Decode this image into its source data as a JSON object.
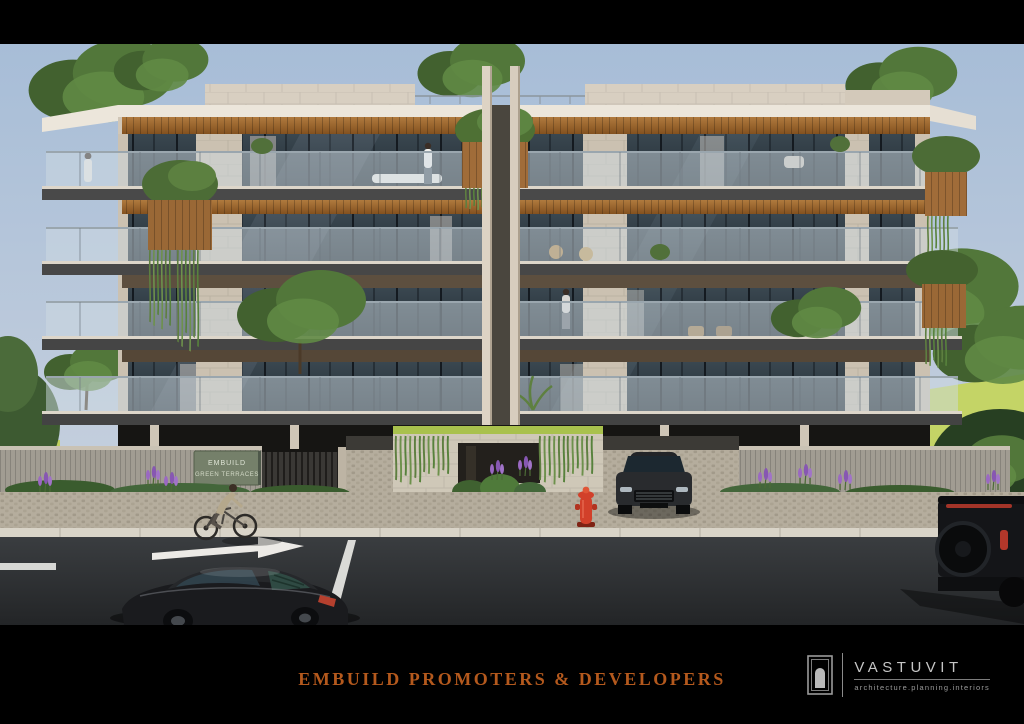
{
  "artwork": {
    "type": "architectural-exterior-render",
    "palette": {
      "sky_top": "#a7bdd7",
      "sky_bottom": "#d6dce3",
      "facade": "#d0c6b7",
      "parapet": "#d8cfc1",
      "wood_soffit": "#9a6530",
      "window_glass": "#2d3a43",
      "railing_glass": "#cdd9e2",
      "slab_fascia": "#494949",
      "road": "#2c2e30",
      "sidewalk_cobble": "#b6ae9e",
      "grass": "#c3d162",
      "foliage": "#4d6c38",
      "compound_wall": "#a19c92",
      "fire_hydrant": "#d2402a"
    }
  },
  "signboard": {
    "line1": "EMBUILD",
    "line2": "GREEN TERRACES"
  },
  "caption": {
    "title": "EMBUILD PROMOTERS & DEVELOPERS",
    "color": "#b4591d"
  },
  "logo": {
    "name": "VASTUVIT",
    "tagline": "architecture.planning.interiors",
    "icon": "arched-door-icon"
  }
}
